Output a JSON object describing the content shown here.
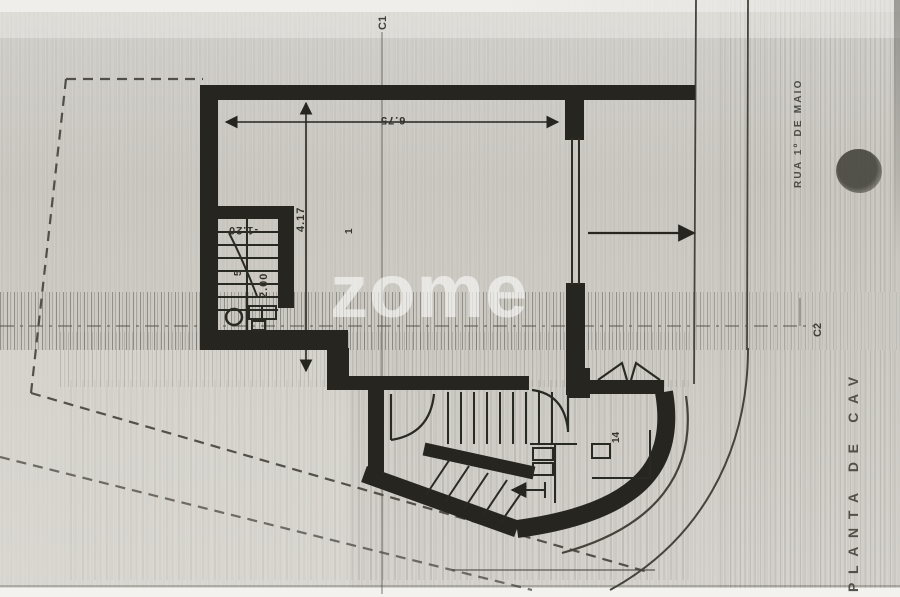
{
  "plan": {
    "side_title": "PLANTA DE CAV",
    "street_name": "RUA 1º DE MAIO",
    "watermark": "zome"
  },
  "axes": {
    "c1": "C1",
    "c2": "C2"
  },
  "dimensions": {
    "room_width": "6.75",
    "room_depth": "4.17",
    "stair_width": "2.00",
    "floor_level": "-1.20"
  },
  "rooms": {
    "r1": "1",
    "r5": "5",
    "r14": "14"
  },
  "colors": {
    "paper": "#cdcac4",
    "ink": "#26251f",
    "watermark_white": "#ffffff"
  }
}
